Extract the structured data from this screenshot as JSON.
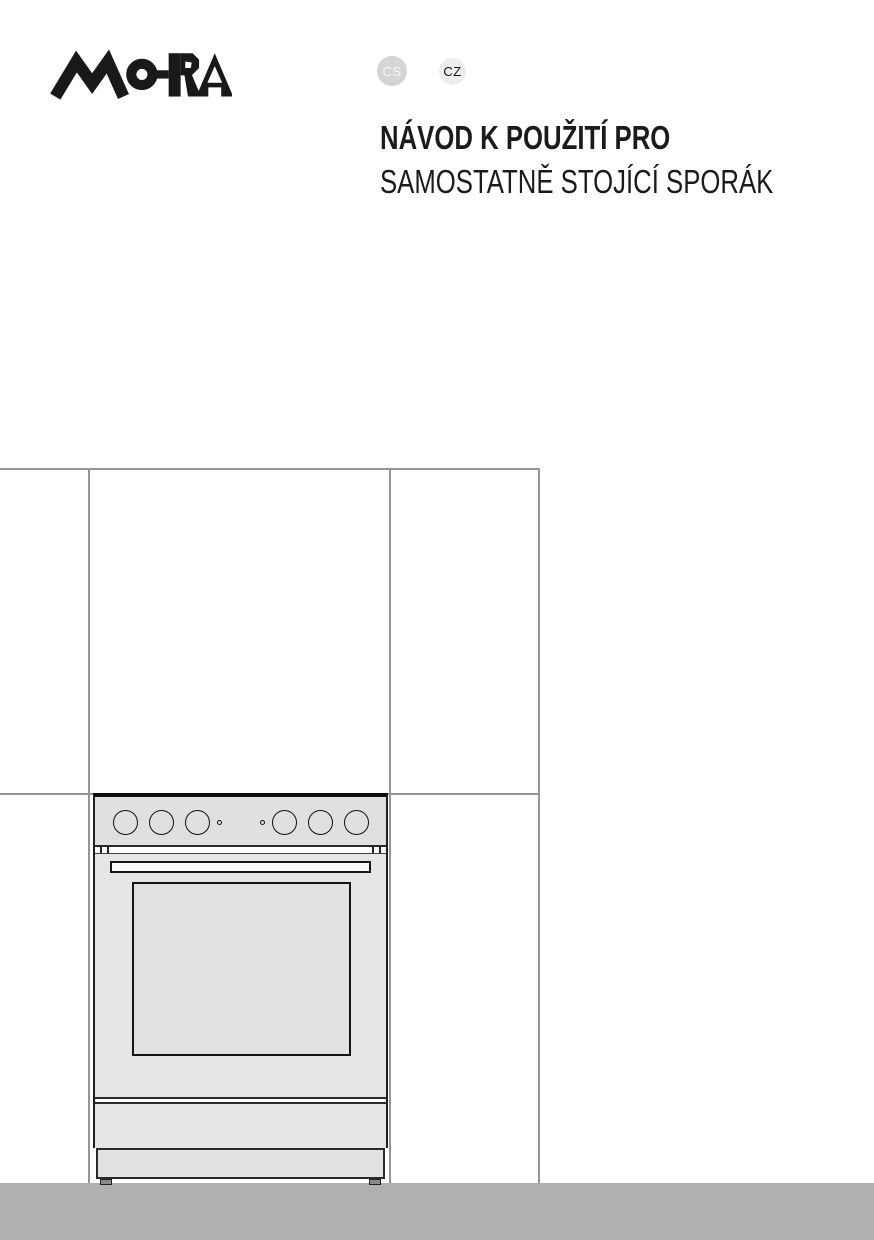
{
  "brand": {
    "name": "MORA"
  },
  "language_badges": [
    {
      "label": "CS"
    },
    {
      "label": "CZ"
    }
  ],
  "title": {
    "line1": "NÁVOD K POUŽITÍ PRO",
    "line2": "SAMOSTATNĚ STOJÍCÍ SPORÁK"
  },
  "illustration": {
    "knob_count": 6,
    "indicator_dot_count": 2
  },
  "colors": {
    "logo": "#191919",
    "title": "#1b1b1b",
    "cs-bg": "#d5d5d5",
    "cs-text": "#f7f7f7",
    "cz-bg": "#ededed",
    "cz-text": "#161616",
    "outline": "#939598",
    "floor": "#aeb0b2",
    "ink": "#1f1f1f",
    "stove-body": "#e6e6e6",
    "stove-panel": "#e0e0e0",
    "stove-window": "#e1e1e1",
    "handle": "#fafafa"
  }
}
